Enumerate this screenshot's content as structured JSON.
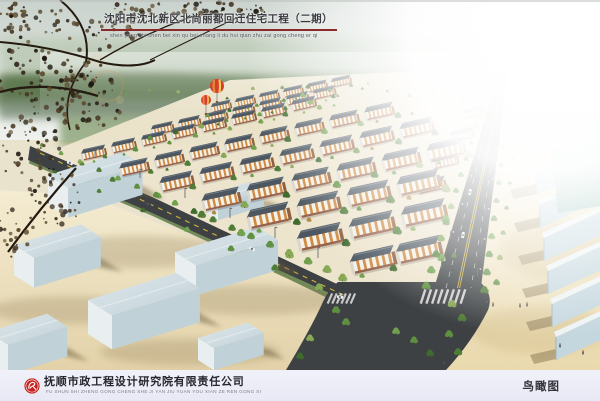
{
  "header": {
    "title": "沈阳市沈北新区北尚丽都回迁住宅工程（二期）",
    "title_pinyin": "shen yang shi shen bei xin qu bei shang li du hui qian zhu zai gong cheng er qi"
  },
  "footer": {
    "company": "抚顺市政工程设计研究院有限责任公司",
    "company_pinyin": "FU SHUN SHI ZHENG GONG CHENG SHE JI YAN JIU YUAN YOU XIAN ZE REN GONG SI",
    "view_label": "鸟瞰图"
  },
  "colors": {
    "title_underline": "#8b2a2a",
    "logo_red": "#c5231f",
    "footer_bg": "#e9e9f5",
    "roof": "#4c5761",
    "roof_ridge": "#78828c",
    "facade": "#f3f1e8",
    "stripe": "#d08a43",
    "gable": "#8f5f3e",
    "brick": "#96604a",
    "asphalt": "#3d4143",
    "lane_yellow": "#d4b43a",
    "ground_cream": "#ece4cc",
    "beige_left": "#f0e6c9",
    "beige_right": "#f5eed8",
    "warehouse_blue": "#cdd9de",
    "shed_blue": "#c4d7de",
    "tree_green": "#4e7c35",
    "sky_top": "#c9d2cc",
    "balloon_red": "#d6402b",
    "balloon_orange": "#e0883a"
  },
  "scene": {
    "type": "architectural-aerial-rendering",
    "balloons": {
      "count": 2
    },
    "elements": [
      "residential building rows",
      "perimeter roads with intersection",
      "street trees",
      "warehouse district foreground",
      "hot air balloons",
      "tree branch overlay top-left"
    ]
  }
}
